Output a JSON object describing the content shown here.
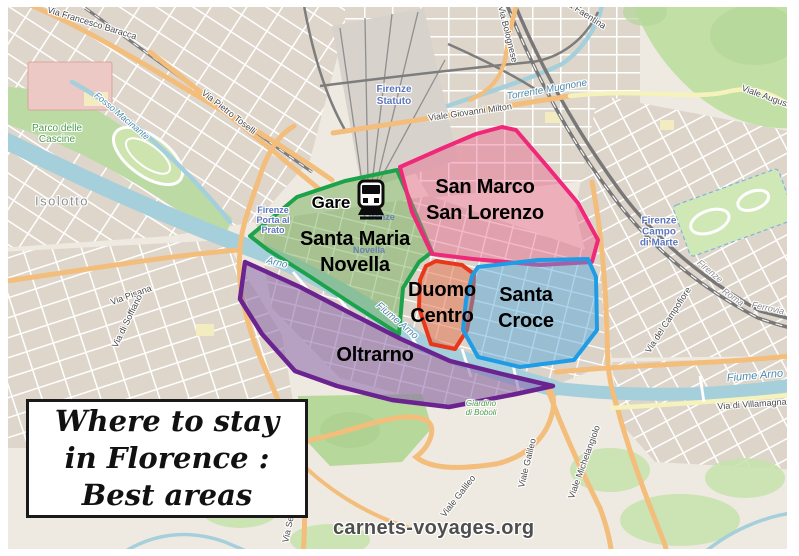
{
  "title_box": {
    "line1": "Where to stay",
    "line2": "in Florence :",
    "line3": "Best areas"
  },
  "watermark": {
    "text": "carnets-voyages.org"
  },
  "station_marker": {
    "label": "Gare"
  },
  "regions": [
    {
      "name": "Santa Maria Novella",
      "line1": "Santa Maria",
      "line2": "Novella",
      "stroke": "#1ca24b",
      "fill": "rgba(105,170,75,0.45)"
    },
    {
      "name": "San Marco San Lorenzo",
      "line1": "San Marco",
      "line2": "San Lorenzo",
      "stroke": "#ef2879",
      "fill": "rgba(233,93,133,0.42)"
    },
    {
      "name": "Duomo Centro",
      "line1": "Duomo",
      "line2": "Centro",
      "stroke": "#e8371b",
      "fill": "rgba(228,112,74,0.52)"
    },
    {
      "name": "Santa Croce",
      "line1": "Santa",
      "line2": "Croce",
      "stroke": "#1f9ce6",
      "fill": "rgba(73,163,222,0.45)"
    },
    {
      "name": "Oltrarno",
      "line1": "Oltrarno",
      "line2": "",
      "stroke": "#6b2390",
      "fill": "rgba(132,94,166,0.52)"
    }
  ],
  "map_labels": {
    "streets": [
      {
        "text": "Via Francesco Baracca"
      },
      {
        "text": "Via Pietro Toselli"
      },
      {
        "text": "Viale Giovanni Milton"
      },
      {
        "text": "Via Bolognese"
      },
      {
        "text": "Via Faentina"
      },
      {
        "text": "Viale Augusto"
      },
      {
        "text": "Via del Campofiore"
      },
      {
        "text": "Via di Villamagna"
      },
      {
        "text": "Via Pisana"
      },
      {
        "text": "Via di Soffiano"
      },
      {
        "text": "Viale Galileo"
      },
      {
        "text": "Viale Galileo"
      },
      {
        "text": "Viale Michelangiolo"
      },
      {
        "text": "Via Senese"
      }
    ],
    "water": [
      {
        "text": "Fiume Arno"
      },
      {
        "text": "Fiume Arno"
      },
      {
        "text": "Arno"
      },
      {
        "text": "Torrente Mugnone"
      },
      {
        "text": "Fosso Macinante"
      }
    ],
    "stations": [
      {
        "line1": "Firenze",
        "line2": "Porta al",
        "line3": "Prato"
      },
      {
        "line1": "Firenze",
        "line2": "Statuto",
        "line3": ""
      },
      {
        "line1": "Firenze",
        "line2": "Campo",
        "line3": "di Marte"
      },
      {
        "line1": "Firenze",
        "line2": "",
        "line3": ""
      },
      {
        "line1": "Novella",
        "line2": "",
        "line3": ""
      }
    ],
    "places": [
      {
        "line1": "Parco delle",
        "line2": "Cascine"
      },
      {
        "line1": "Isolotto",
        "line2": ""
      },
      {
        "line1": "Giardino",
        "line2": "di Boboli"
      }
    ],
    "railway": [
      {
        "text": "Firenze"
      },
      {
        "text": "Roma"
      },
      {
        "text": "Ferrovia"
      }
    ]
  }
}
